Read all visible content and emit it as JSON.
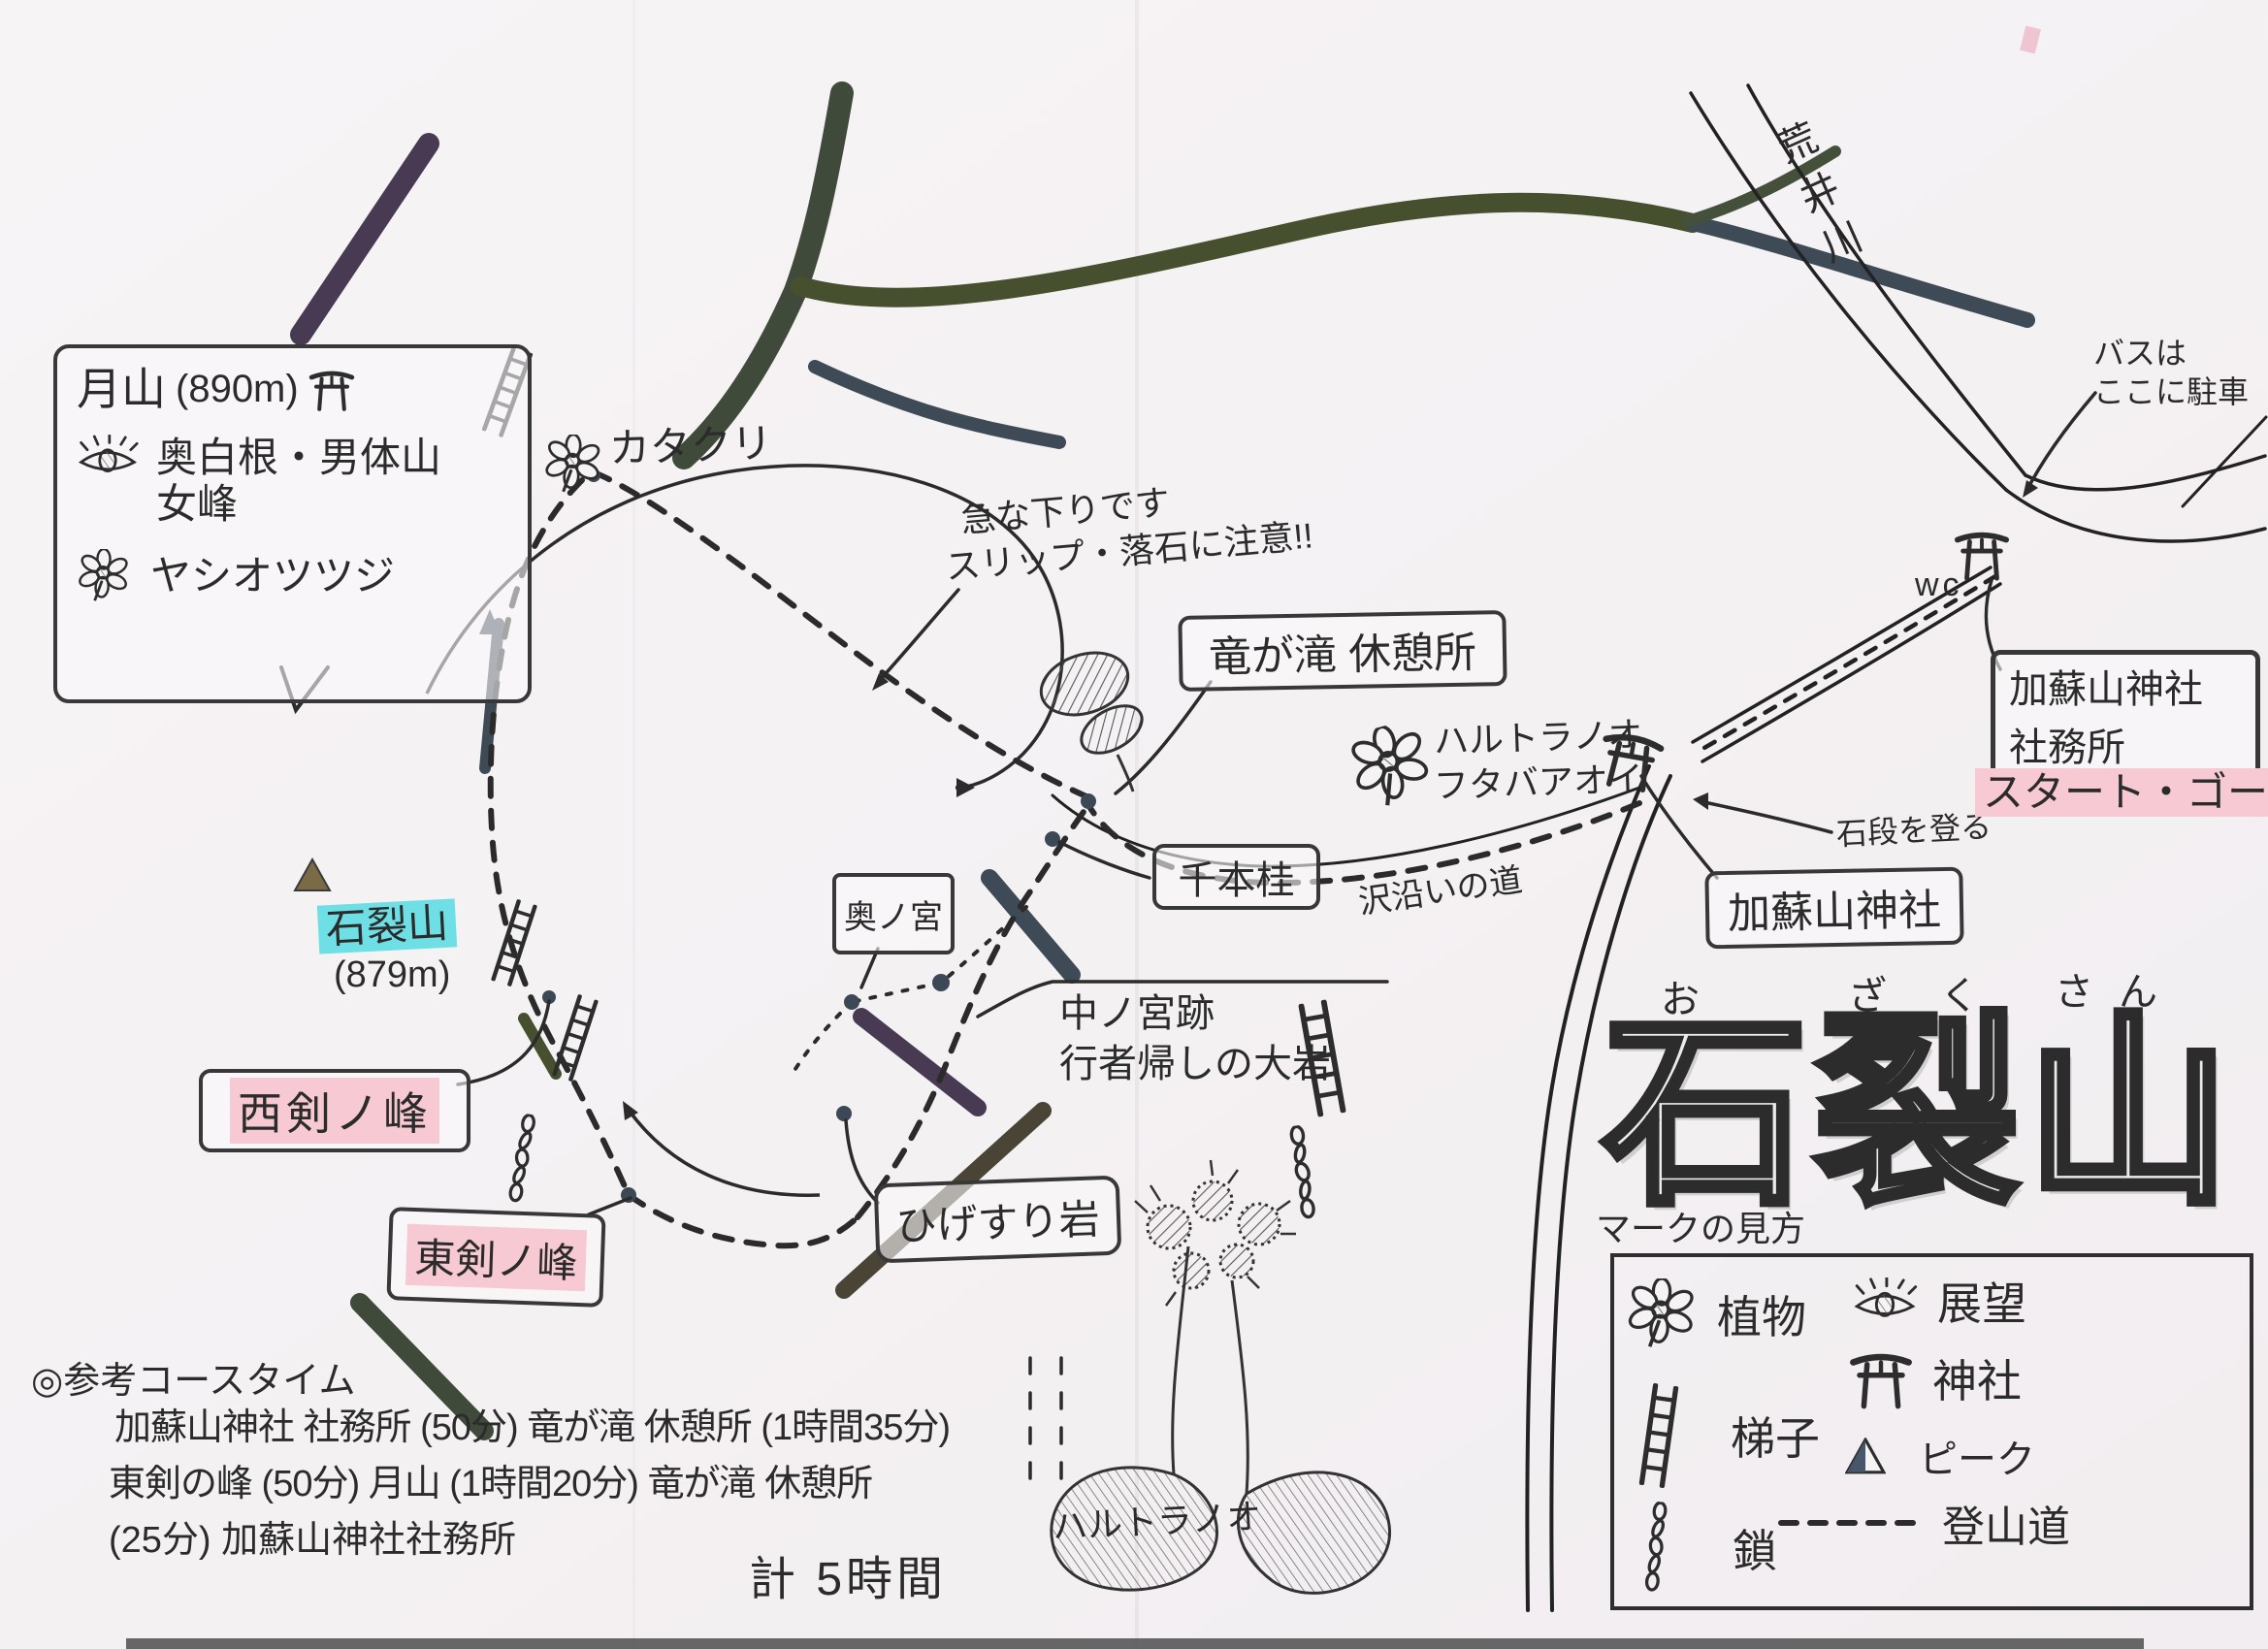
{
  "colors": {
    "paper": "#f6f3f5",
    "ink": "#2b2b2b",
    "highlight_cyan": "#6fdfe6",
    "highlight_pink": "#f7c9d2",
    "branch_olive": "#46502f",
    "branch_slate": "#3e4a55",
    "branch_plum": "#473a52"
  },
  "icons": {
    "torii-icon": "⛩",
    "flower-icon": "✿",
    "eye-icon": "◉",
    "ladder-icon": "☰",
    "chain-icon": "߷",
    "peak-icon": "▲",
    "trail-icon": "┅"
  },
  "title": {
    "furigana": [
      "お",
      "ざ",
      "く",
      "さん"
    ],
    "characters": [
      "石",
      "裂",
      "山"
    ]
  },
  "summit_box": {
    "name": "月山",
    "elevation": "(890m)",
    "view_line1": "奥白根・男体山",
    "view_line2": "女峰",
    "plant": "ヤシオツツジ"
  },
  "labels": {
    "katakuri": "カタクリ",
    "warning_line1": "急な下りです",
    "warning_line2": "スリップ・落石に注意!!",
    "ryugataki_rest": "竜が滝 休憩所",
    "harutoranoo": "ハルトラノオ",
    "futabaaoi": "フタバアオイ",
    "senbonkatsura": "千本桂",
    "okunomiya": "奥ノ宮",
    "nakanomiya_line1": "中ノ宮跡",
    "nakanomiya_line2": "行者帰しの大岩",
    "higesuri_iwa": "ひげすり岩",
    "ozakusan": "石裂山",
    "ozakusan_elevation": "(879m)",
    "nishiken_no_mine": "西剣ノ峰",
    "higashiken_no_mine": "東剣ノ峰",
    "kasoyama_jinja": "加蘇山神社",
    "ishidan": "石段を登る",
    "sawazoi": "沢沿いの道",
    "shamusho_line1": "加蘇山神社",
    "shamusho_line2": "社務所",
    "start_goal": "スタート・ゴール",
    "bus_line1": "バスは",
    "bus_line2": "ここに駐車",
    "wc": "wc",
    "araigawa": "荒井川",
    "harutoranoo_bottom": "ハルトラノオ"
  },
  "legend": {
    "title": "マークの見方",
    "items": [
      {
        "icon": "flower-icon",
        "label": "植物"
      },
      {
        "icon": "ladder-icon",
        "label": "梯子"
      },
      {
        "icon": "chain-icon",
        "label": "鎖"
      },
      {
        "icon": "eye-icon",
        "label": "展望"
      },
      {
        "icon": "torii-icon",
        "label": "神社"
      },
      {
        "icon": "peak-icon",
        "label": "ピーク"
      },
      {
        "icon": "trail-icon",
        "label": "登山道"
      }
    ]
  },
  "course_time": {
    "heading": "◎参考コースタイム",
    "line1": "加蘇山神社 社務所 (50分) 竜が滝 休憩所 (1時間35分)",
    "line2": "東剣の峰 (50分) 月山 (1時間20分) 竜が滝 休憩所",
    "line3": "(25分) 加蘇山神社社務所",
    "total": "計 5時間"
  }
}
